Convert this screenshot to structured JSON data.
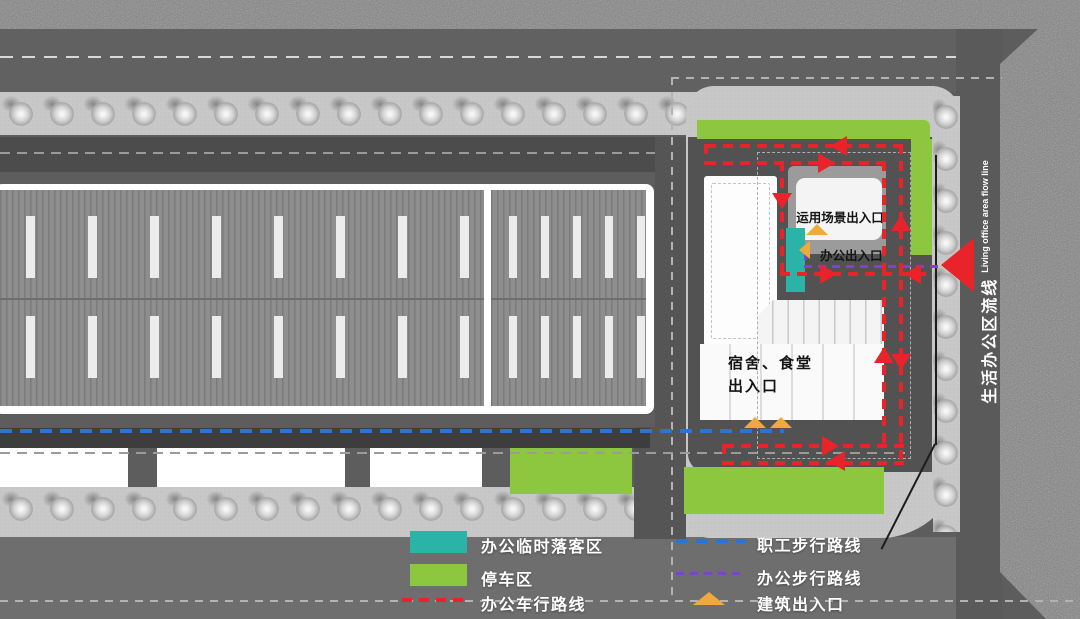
{
  "site_plan": {
    "annotations": {
      "scene_entrance": "运用场景出入口",
      "office_entrance": "办公出入口",
      "dorm_canteen_line1": "宿舍、食堂",
      "dorm_canteen_line2": "出入口"
    },
    "street_label": {
      "cn": "生活办公区流线",
      "en": "Living office area flow line"
    }
  },
  "legend": {
    "left": [
      {
        "swatch": "teal-area",
        "label": "办公临时落客区"
      },
      {
        "swatch": "green-area",
        "label": "停车区"
      },
      {
        "swatch": "red-dash",
        "label": "办公车行路线"
      }
    ],
    "right": [
      {
        "swatch": "blue-dash",
        "label": "职工步行路线"
      },
      {
        "swatch": "purple-dash",
        "label": "办公步行路线"
      },
      {
        "swatch": "yellow-arrow",
        "label": "建筑出入口"
      }
    ]
  },
  "colors": {
    "dropoff_teal": "#2cb3a8",
    "parking_green": "#8dc63f",
    "vehicle_route_red": "#e8232a",
    "worker_route_blue": "#2e74ce",
    "office_route_purple": "#7d44c9",
    "entrance_yellow": "#f0a93c"
  }
}
